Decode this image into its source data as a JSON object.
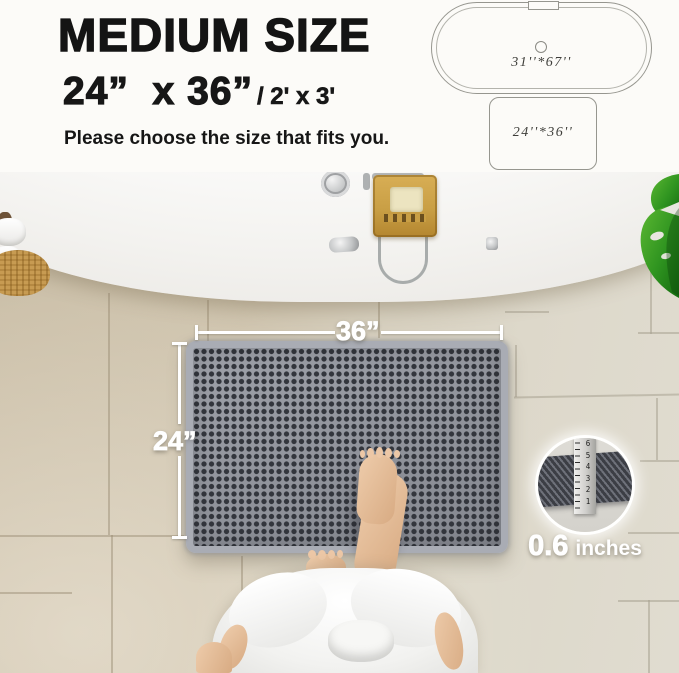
{
  "header": {
    "title": "MEDIUM SIZE",
    "size_primary": "24”  x 36”",
    "size_secondary": "/ 2' x 3'",
    "subtitle": "Please choose the size that fits you."
  },
  "diagram": {
    "bathtub_label": "31''*67''",
    "mat_label": "24''*36''"
  },
  "photo": {
    "width_label": "36”",
    "height_label": "24”",
    "thickness_value": "0.6",
    "thickness_unit": "inches",
    "ruler_numbers": [
      "6",
      "5",
      "4",
      "3",
      "2",
      "1"
    ]
  },
  "icons": {
    "bathtub_diagram": "bathtub-top-view-outline",
    "mat_diagram": "rug-rectangle-outline",
    "leaf": "monstera-leaf",
    "ruler": "thickness-ruler"
  },
  "colors": {
    "mat_gray": "#84878f",
    "mat_dark": "#33363d",
    "mat_fringe": "#a9acb4",
    "tile_left": "#cbbfa8",
    "tile_right": "#e0dcd0",
    "leaf_green": "#3f9c26",
    "caddy_wood": "#c99f45",
    "skin": "#e2bc9d",
    "overlay_white": "#ffffff",
    "text_black": "#141414"
  }
}
